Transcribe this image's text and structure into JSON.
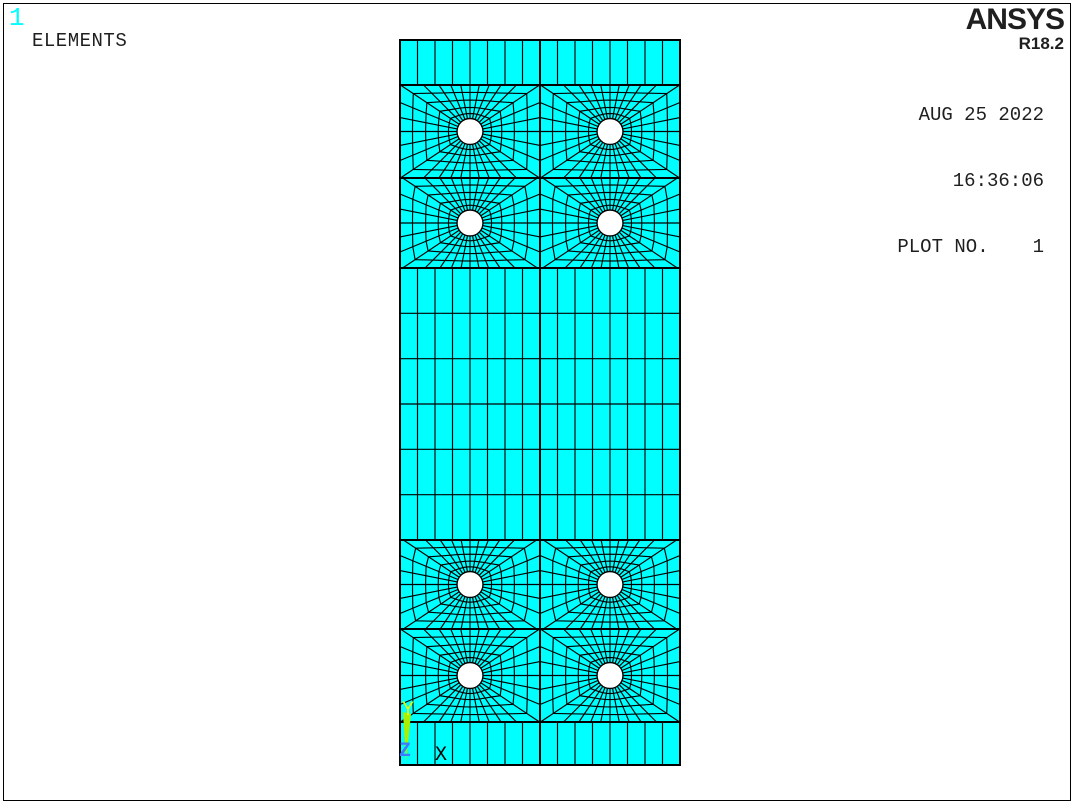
{
  "window": {
    "bg": "#ffffff",
    "border_color": "#000000"
  },
  "header": {
    "window_id": "1",
    "window_id_color": "#00ffff",
    "label": "ELEMENTS"
  },
  "brand": {
    "logo": "ANSYS",
    "release": "R18.2",
    "color": "#1f1f1f"
  },
  "info": {
    "date": "AUG 25 2022",
    "time": "16:36:06",
    "plot_no_label": "PLOT NO.",
    "plot_no_value": "1"
  },
  "triad": {
    "x_label": "X",
    "y_label": "Y",
    "z_label": "Z",
    "x_color": "#000000",
    "y_color": "#e6ff00",
    "z_color": "#3a7bff",
    "arrow_color": "#aaee00",
    "arrow_points": "403,712 411,714 406,762"
  },
  "mesh": {
    "element_fill": "#00ffff",
    "edge_color": "#000000",
    "hole_fill": "#ffffff",
    "plate": {
      "x": 400,
      "y": 40,
      "width": 280,
      "height": 725
    },
    "columns": 16,
    "top_strip": {
      "y0": 40,
      "y1": 85
    },
    "grid_block": {
      "y0": 268,
      "y1": 540,
      "rows": 6
    },
    "bottom_strip": {
      "y0": 722,
      "y1": 765
    },
    "hole_bands": [
      {
        "y0": 85,
        "y1": 178
      },
      {
        "y0": 178,
        "y1": 268
      },
      {
        "y0": 540,
        "y1": 629
      },
      {
        "y0": 629,
        "y1": 722
      }
    ],
    "blocks_per_band": 2,
    "hole_radius": 13,
    "spokes": 32,
    "rings": [
      0.15,
      0.33,
      0.55,
      0.78
    ],
    "boundary_lines_y": [
      85,
      178,
      268,
      540,
      629,
      722
    ],
    "inner_width": 1.15,
    "outline_width": 2
  }
}
